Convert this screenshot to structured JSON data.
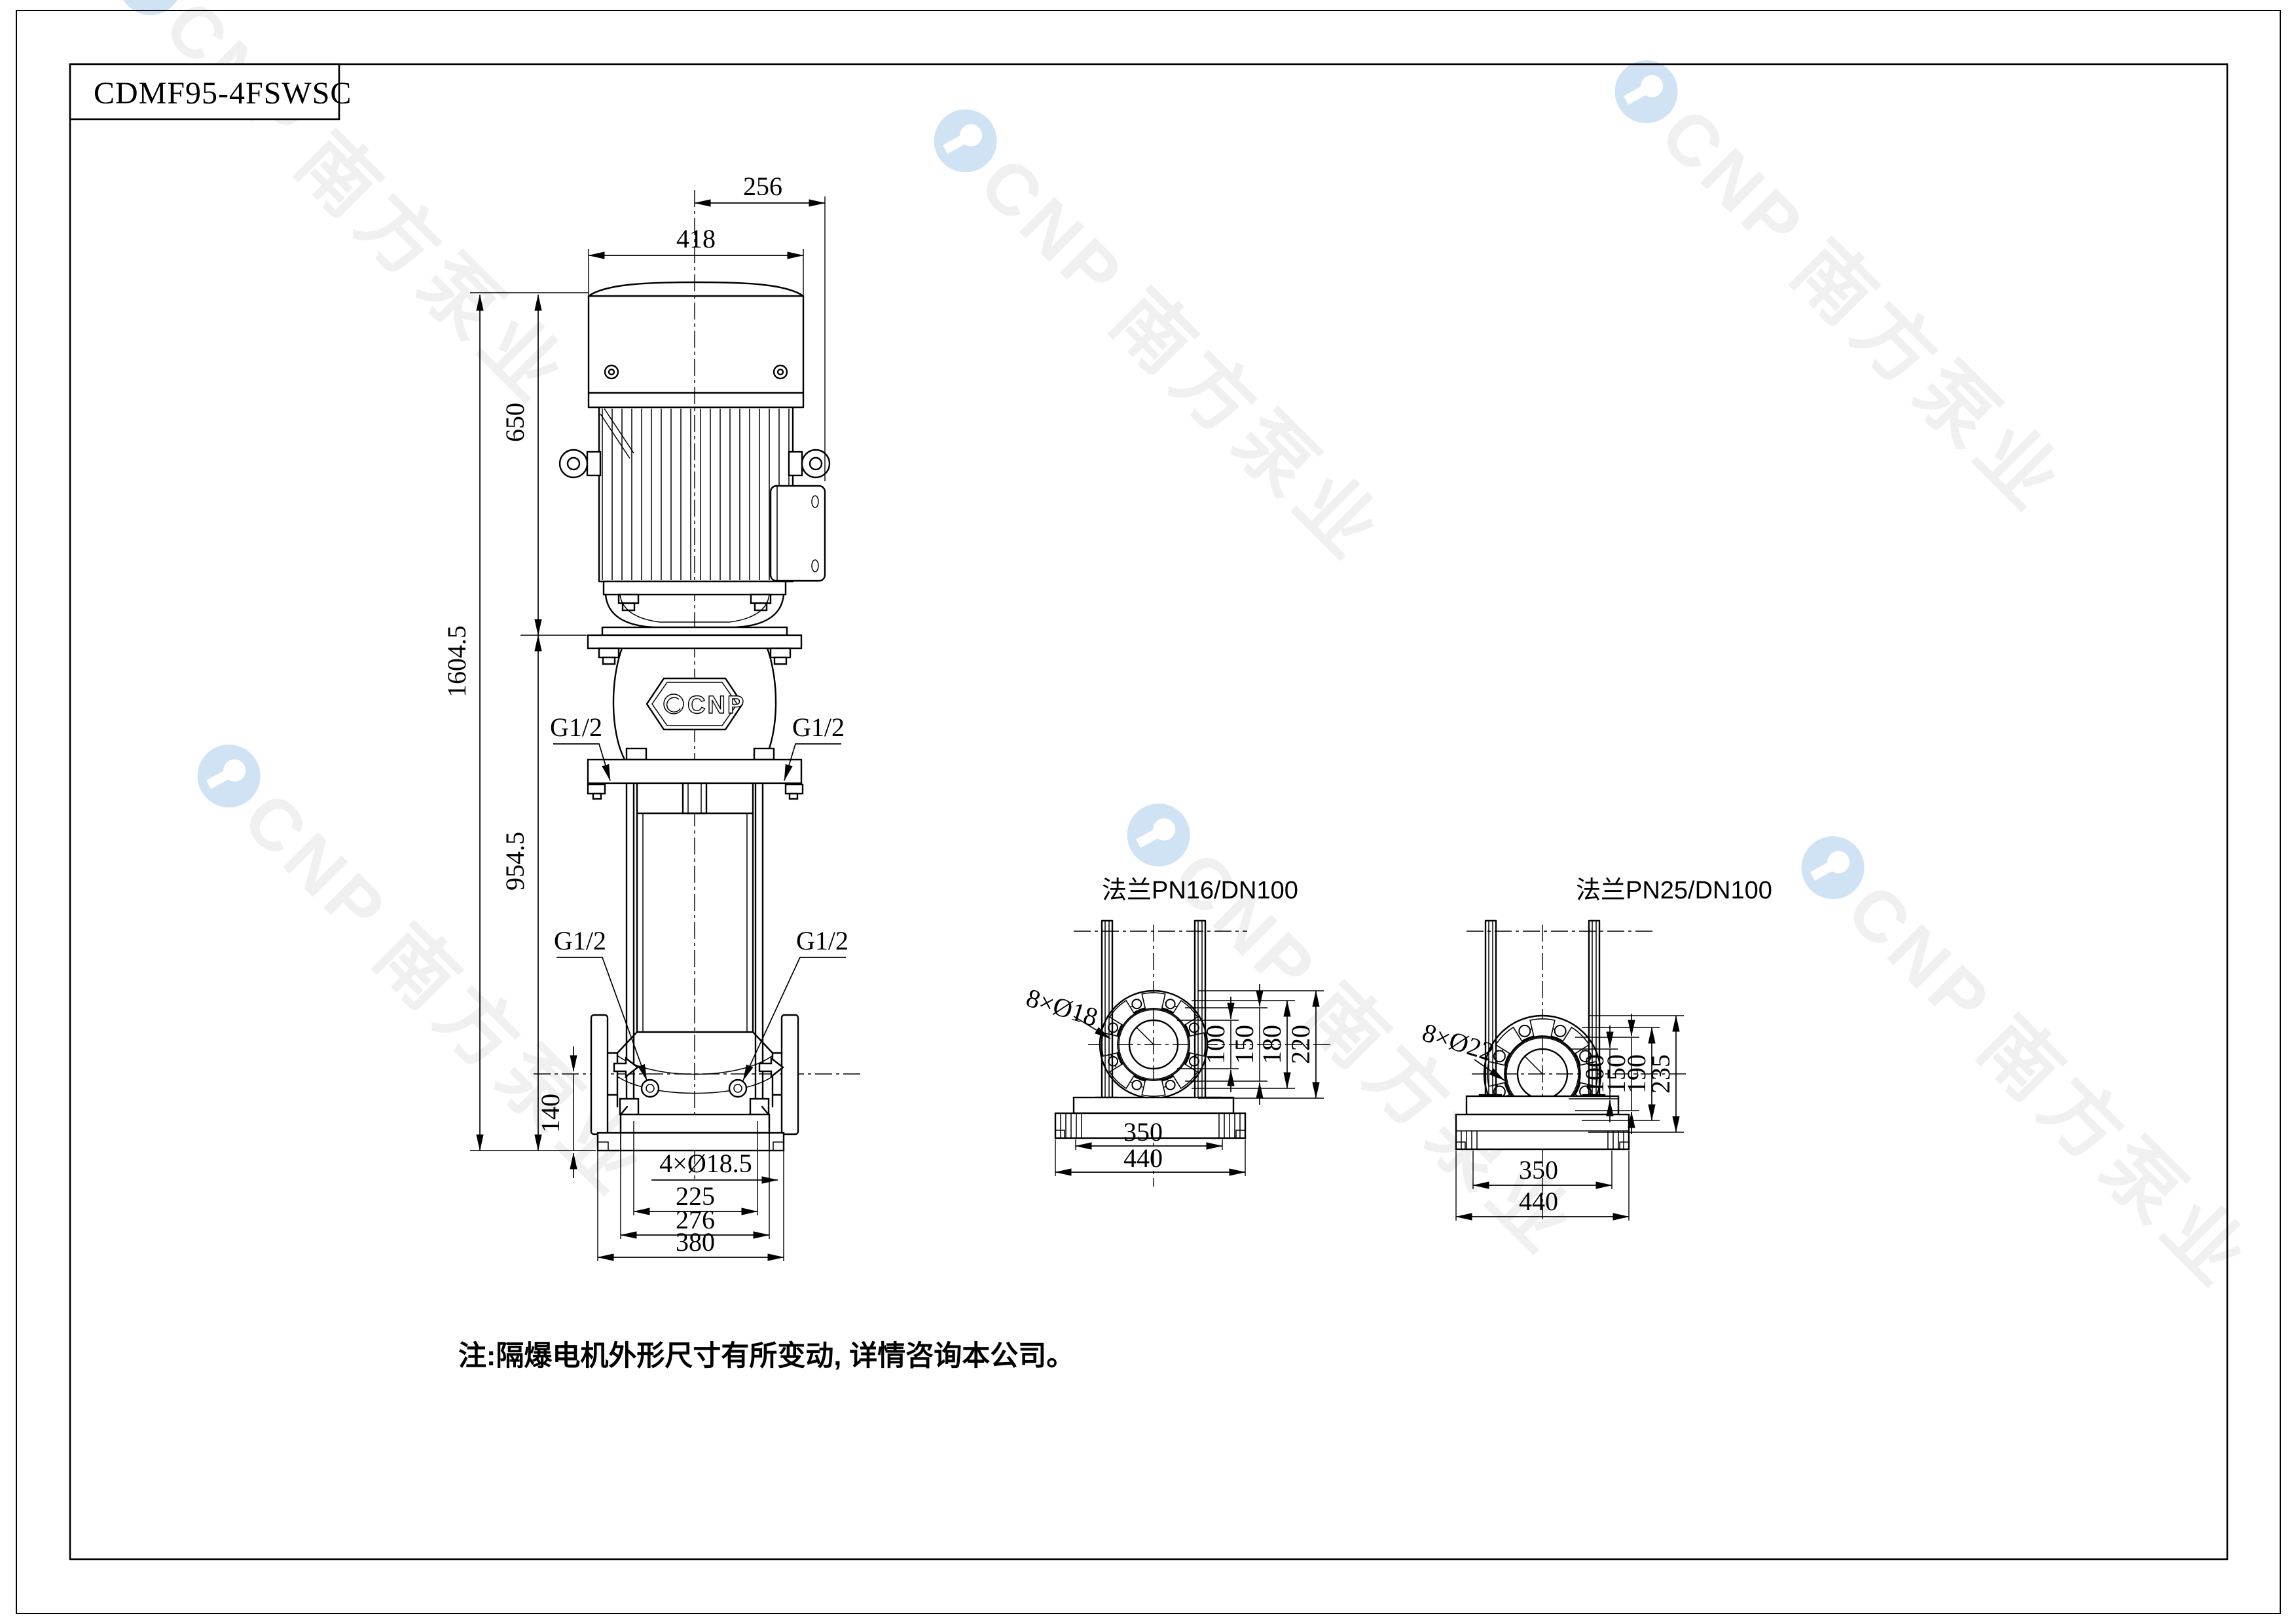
{
  "page": {
    "title_block_model": "CDMF95-4FSWSC",
    "note": "注:隔爆电机外形尺寸有所变动, 详情咨询本公司。"
  },
  "watermark": {
    "brand": "CNP",
    "brand_cn": "南方泵业",
    "logo_color": "#cfe3f4",
    "text_color": "#f0f0f0"
  },
  "main_view": {
    "badge": "CNP",
    "dims": {
      "terminal_box_offset": "256",
      "motor_width": "418",
      "motor_height": "650",
      "total_height": "1604.5",
      "pump_height": "954.5",
      "port_centerline_height": "140",
      "port_thread": "G1/2",
      "anchor_holes": "4×Ø18.5",
      "base_width_inner": "225",
      "base_width_mid": "276",
      "base_width_outer": "380"
    }
  },
  "flange_views": [
    {
      "title": "法兰PN16/DN100",
      "bolt_holes": "8×Ø18",
      "diameters": [
        "100",
        "150",
        "180",
        "220"
      ],
      "base_widths": [
        "350",
        "440"
      ]
    },
    {
      "title": "法兰PN25/DN100",
      "bolt_holes": "8×Ø22",
      "diameters": [
        "100",
        "150",
        "190",
        "235"
      ],
      "base_widths": [
        "350",
        "440"
      ]
    }
  ],
  "colors": {
    "line": "#000000",
    "background": "#ffffff"
  }
}
